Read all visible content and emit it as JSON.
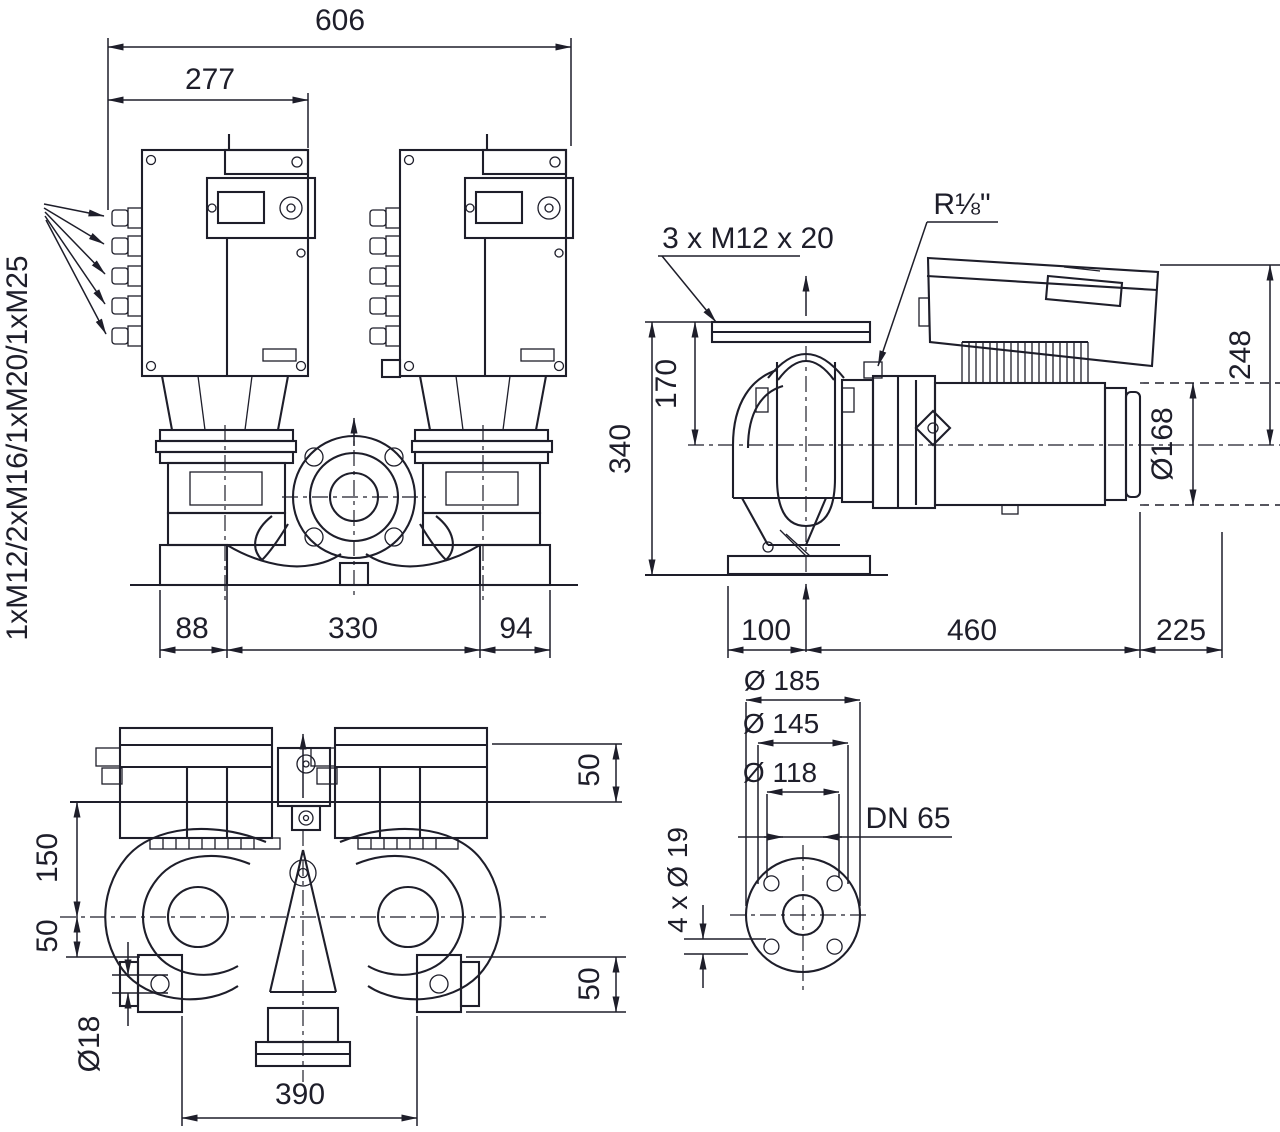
{
  "drawing_title": "Twin-head inline pump dimensional drawing",
  "line_color": "#1e1e2a",
  "background_color": "#ffffff",
  "views": {
    "front": {
      "dim_total_width": "606",
      "dim_box_width": "277",
      "label_cable_glands": "1xM12/2xM16/1xM20/1xM25",
      "dim_foot_left": "88",
      "dim_port_span": "330",
      "dim_foot_right": "94"
    },
    "side": {
      "label_bolt_holes": "3 x M12 x 20",
      "label_vent_plug": "R⅛\"",
      "dim_height_total": "340",
      "dim_axis_height": "170",
      "dim_box_height": "248",
      "dim_motor_dia": "Ø168",
      "dim_foot_offset": "100",
      "dim_axis_to_motor_end": "460",
      "dim_motor_end_to_box": "225"
    },
    "top": {
      "dim_plate_to_axis": "150",
      "dim_axis_to_foot": "50",
      "dim_rear_overhang": "50",
      "dim_foot_to_flange": "50",
      "label_foot_hole": "Ø18",
      "dim_foot_span": "390"
    },
    "flange": {
      "dim_outer": "Ø 185",
      "dim_bolt_circle": "Ø 145",
      "dim_hub": "Ø 118",
      "label_nominal": "DN 65",
      "label_bolt_holes": "4 x Ø 19"
    }
  }
}
